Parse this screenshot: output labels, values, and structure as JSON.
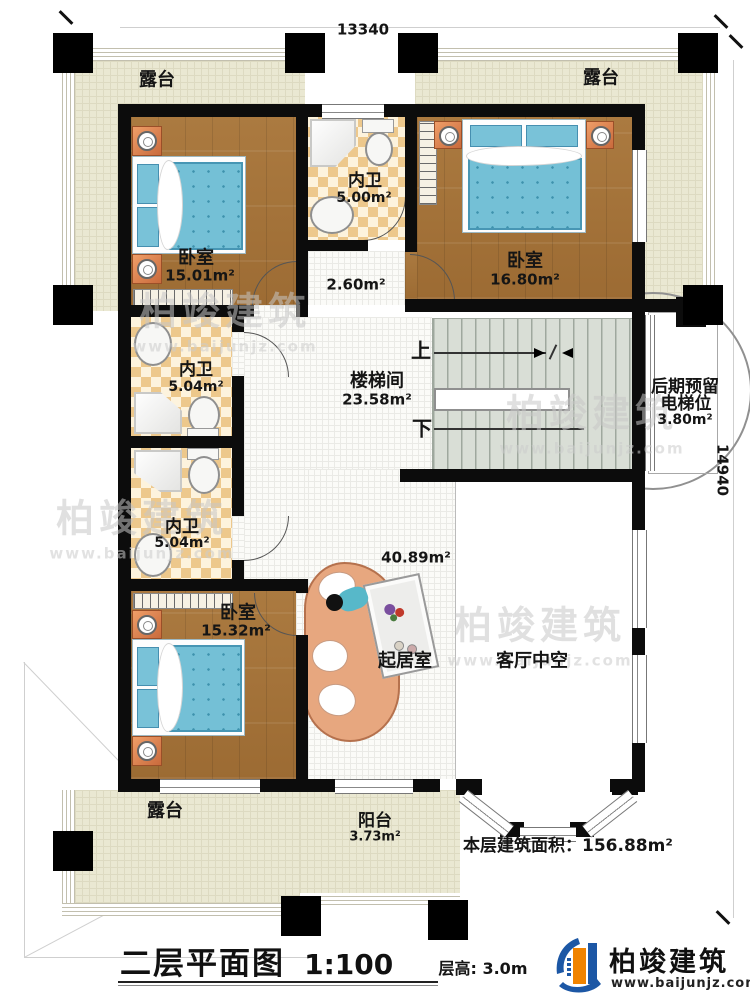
{
  "dimensions": {
    "top": "13340",
    "right": "14940"
  },
  "rooms": {
    "terrace": {
      "name": "露台"
    },
    "balcony": {
      "name": "阳台",
      "area": "3.73m²"
    },
    "bedroom1": {
      "name": "卧室",
      "area": "15.01m²"
    },
    "bedroom2": {
      "name": "卧室",
      "area": "16.80m²"
    },
    "bedroom3": {
      "name": "卧室",
      "area": "15.32m²"
    },
    "bath1": {
      "name": "内卫",
      "area": "5.00m²"
    },
    "bath2": {
      "name": "内卫",
      "area": "5.04m²"
    },
    "bath3": {
      "name": "内卫",
      "area": "5.04m²"
    },
    "hall": {
      "area": "2.60m²"
    },
    "stairwell": {
      "name": "楼梯间",
      "area": "23.58m²"
    },
    "living": {
      "name": "起居室",
      "area": "40.89m²"
    },
    "void": {
      "name": "客厅中空"
    },
    "elevator": {
      "line1": "后期预留",
      "line2": "电梯位",
      "area": "3.80m²"
    },
    "stairs": {
      "up": "上",
      "down": "下"
    }
  },
  "summary": {
    "label": "本层建筑面积：",
    "value": "156.88m²"
  },
  "titleblock": {
    "title": "二层平面图",
    "scale": "1:100",
    "floor_height": "层高: 3.0m"
  },
  "brand": {
    "name": "柏竣建筑",
    "url": "www.baijunjz.com"
  },
  "watermark": {
    "name": "柏竣建筑",
    "url": "www.baijunjz.com"
  },
  "colors": {
    "wall": "#0c0c0c",
    "wood": "#a9763c",
    "tile": "#edc88c",
    "terrace": "#eae8d2",
    "bed": "#74c0d6",
    "brand_blue": "#1c57a5",
    "brand_orange": "#f08300"
  }
}
